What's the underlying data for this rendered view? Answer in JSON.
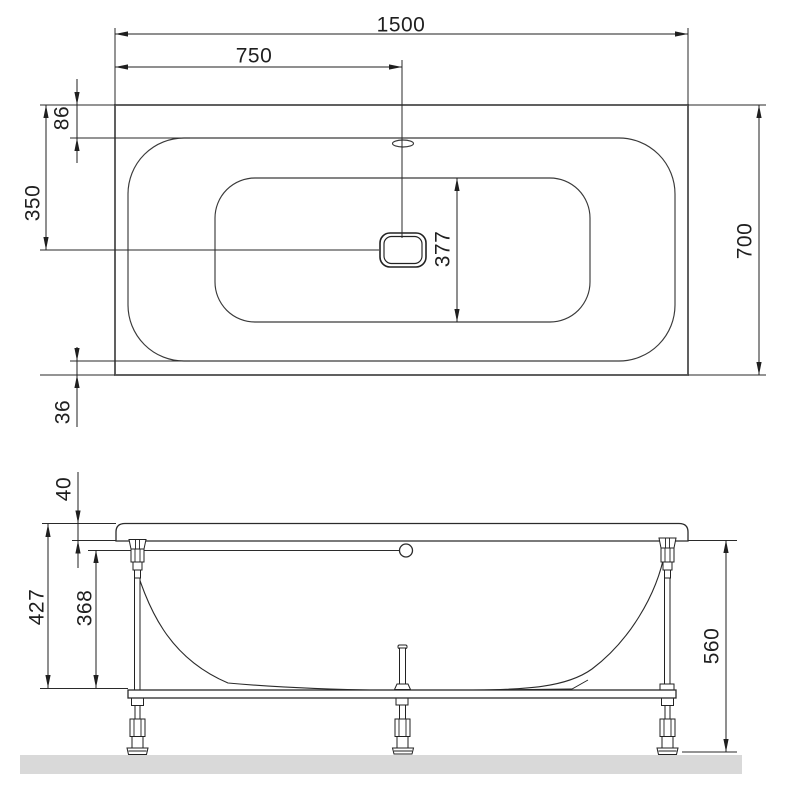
{
  "drawing": {
    "kind": "bathtub-installation-dimensions",
    "views": {
      "top": "top-view",
      "front": "front-elevation"
    }
  },
  "colors": {
    "background": "#ffffff",
    "line_dark": "#1f1f1f",
    "outline_gray": "#4f4f4f",
    "floor_fill": "#d9d9d9"
  },
  "top_view": {
    "dims": {
      "overall_length": "1500",
      "center_from_left": "750",
      "rim_offset_top": "86",
      "center_from_top": "350",
      "basin_inner_width": "377",
      "overall_width": "700",
      "rim_offset_bottom": "36"
    }
  },
  "front_view": {
    "dims": {
      "rim_height": "40",
      "rim_to_frame_height": "427",
      "underside_to_frame_height": "368",
      "overall_height": "560"
    }
  }
}
